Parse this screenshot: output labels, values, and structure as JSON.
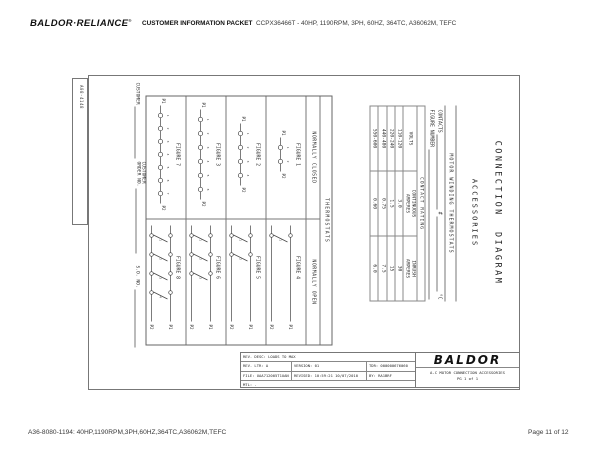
{
  "header": {
    "logo": "BALDOR·RELIANCE",
    "logo_reg": "®",
    "packet_label": "CUSTOMER INFORMATION PACKET",
    "spec": "CCPX36466T - 40HP, 1190RPM, 3PH, 60HZ, 364TC, A36062M, TEFC"
  },
  "footer": {
    "left": "A36-8080-1194: 40HP,1190RPM,3PH,60HZ,364TC,A36062M,TEFC",
    "right": "Page 11 of 12"
  },
  "drawing": {
    "edge_label": "A08-4148",
    "title_line1": "CONNECTION  DIAGRAM",
    "title_line2": "ACCESSORIES",
    "thermostat_header": "MOTOR WINDING THERMOSTATS",
    "contacts_label": "CONTACTS",
    "contacts_hash": "#",
    "contacts_unit": "°C",
    "figure_number_label": "FIGURE NUMBER",
    "contact_rating": {
      "title": "CONTACT RATING",
      "columns": [
        "VOLTS",
        "CONTINUOUS\nAMPERES",
        "INRUSH\nAMPERES"
      ],
      "rows": [
        [
          "110-120",
          "3.0",
          "30"
        ],
        [
          "220-240",
          "1.5",
          "15"
        ],
        [
          "440-480",
          "0.75",
          "7.5"
        ],
        [
          "550-600",
          "0.60",
          "6.0"
        ]
      ]
    },
    "grid": {
      "header_top": "THERMOSTATS",
      "header_left": "NORMALLY CLOSED",
      "header_right": "NORMALLY OPEN",
      "terminal_p1": "P1",
      "terminal_p2": "P2",
      "nc_figures": [
        {
          "label": "FIGURE 1",
          "circles": 2
        },
        {
          "label": "FIGURE 2",
          "circles": 4
        },
        {
          "label": "FIGURE 3",
          "circles": 6
        },
        {
          "label": "FIGURE 7",
          "circles": 7
        }
      ],
      "no_figures": [
        {
          "label": "FIGURE 4",
          "switches": 1
        },
        {
          "label": "FIGURE 5",
          "switches": 2
        },
        {
          "label": "FIGURE 6",
          "switches": 3
        },
        {
          "label": "FIGURE 8",
          "switches": 4
        }
      ]
    },
    "customer_labels": {
      "customer": "CUSTOMER",
      "order_line1": "CUSTOMER",
      "order_line2": "ORDER NO.",
      "so": "S.O. NO."
    },
    "title_block": {
      "rev_desc": "REV. DESC: LOADS TO MAX",
      "rev_ltr": "REV. LTR: A",
      "version": "VERSION: 01",
      "tdr": "TDR: 000000676060",
      "file": "FILE: UAA712005T1UAN",
      "revised": "REVISED: 10:59:21 10/07/2010",
      "by": "BY: RA1BRF",
      "mtl": "MTL: -",
      "logo": "BALDOR",
      "product": "A-C MOTOR CONNECTION ACCESSORIES",
      "pg": "PG 1 of 1"
    }
  }
}
